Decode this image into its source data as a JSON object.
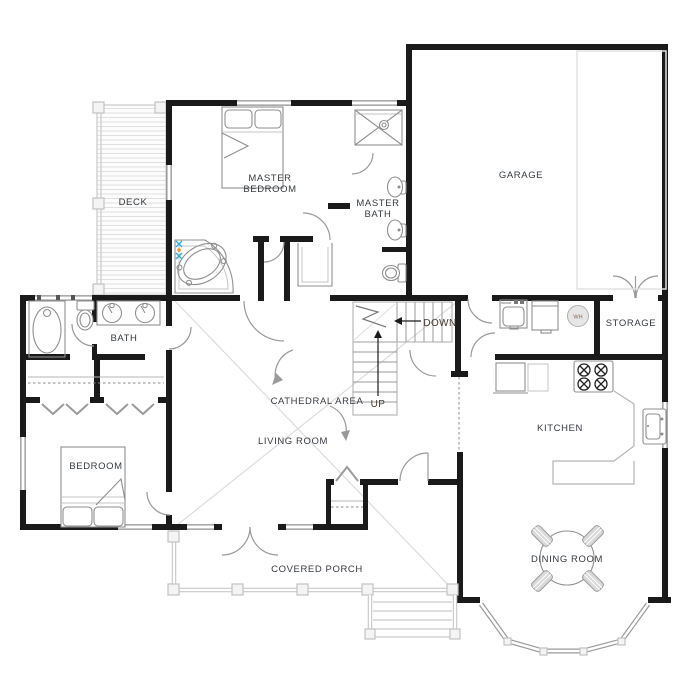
{
  "plan": {
    "rooms": {
      "deck": "DECK",
      "master_bedroom": [
        "MASTER",
        "BEDROOM"
      ],
      "master_bath": [
        "MASTER",
        "BATH"
      ],
      "garage": "GARAGE",
      "bath": "BATH",
      "storage": "STORAGE",
      "cathedral_area": "CATHEDRAL AREA",
      "living_room": "LIVING ROOM",
      "kitchen": "KITCHEN",
      "bedroom": "BEDROOM",
      "covered_porch": "COVERED PORCH",
      "dining_room": "DINING ROOM"
    },
    "stairs": {
      "down_label": "DOWN",
      "up_label": "UP"
    },
    "appliances": {
      "water_heater_label": "WH"
    },
    "colors": {
      "wall": "#1a1a1a",
      "fixture_stroke": "#8f8f8f",
      "label_text": "#363b41",
      "faucet_cold": "#29abe2",
      "faucet_hot": "#f7931e"
    }
  }
}
